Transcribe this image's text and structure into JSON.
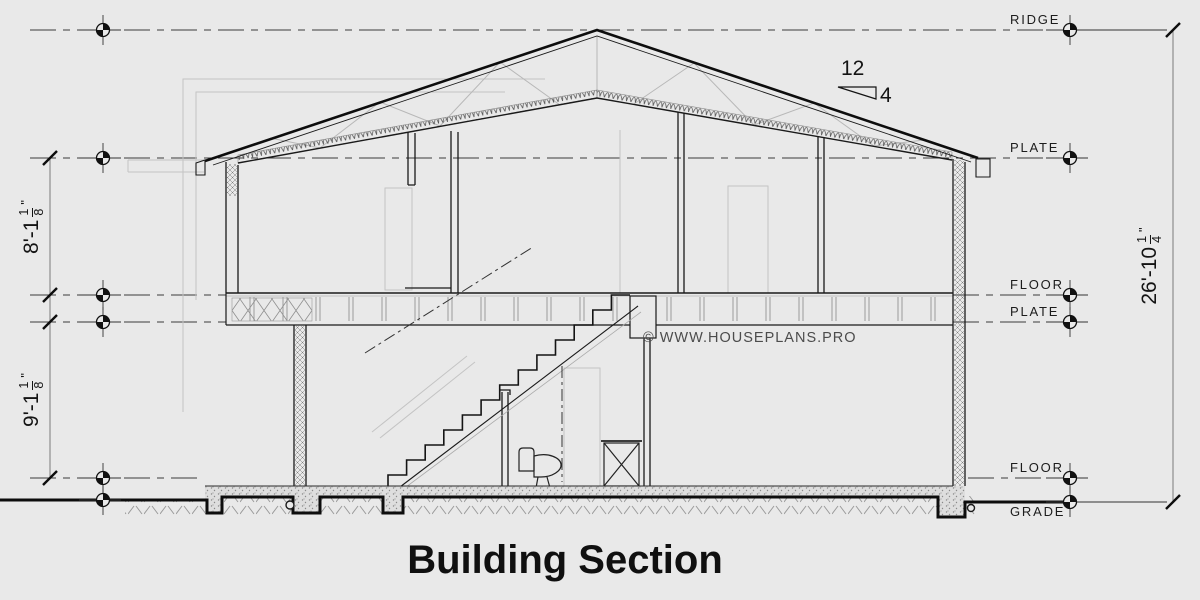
{
  "title": "Building Section",
  "watermark": "© WWW.HOUSEPLANS.PRO",
  "pitch": {
    "run": "12",
    "rise": "4"
  },
  "levels": {
    "ridge": "RIDGE",
    "plate_upper": "PLATE",
    "floor_upper": "FLOOR",
    "plate_lower": "PLATE",
    "floor_lower": "FLOOR",
    "grade": "GRADE"
  },
  "dimensions": {
    "upper_wall": {
      "prefix": "8'-1",
      "frac_num": "1",
      "frac_den": "8",
      "unit": "\""
    },
    "lower_wall": {
      "prefix": "9'-1",
      "frac_num": "1",
      "frac_den": "8",
      "unit": "\""
    },
    "overall": {
      "prefix": "26'-10",
      "frac_num": "1",
      "frac_den": "4",
      "unit": "\""
    }
  },
  "colors": {
    "background": "#e9e9e9",
    "line": "#1a1a1a",
    "light_line": "#c4c4c4",
    "dim_line": "#7a7a7a"
  }
}
